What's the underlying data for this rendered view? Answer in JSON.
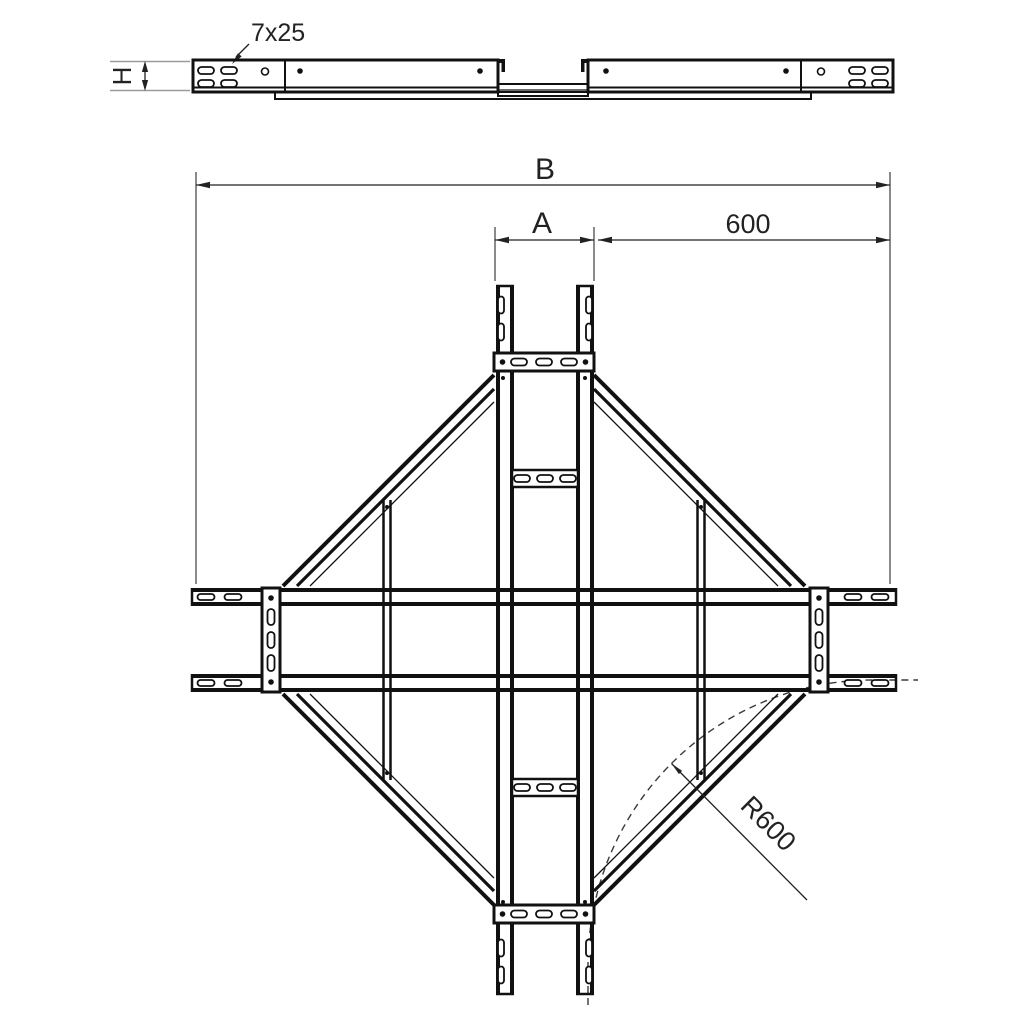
{
  "meta": {
    "drawing_type": "technical drawing",
    "component": "cable ladder cross piece, plan and side view"
  },
  "labels": {
    "slot_size": "7x25",
    "height": "H",
    "overall_width": "B",
    "center_width": "A",
    "branch_length": "600",
    "bend_radius": "R600"
  },
  "colors": {
    "line": "#111111",
    "dimension": "#222222",
    "extension_gray": "#9b9b9b",
    "dashed_arc": "#3a3a3a",
    "background": "#ffffff"
  }
}
